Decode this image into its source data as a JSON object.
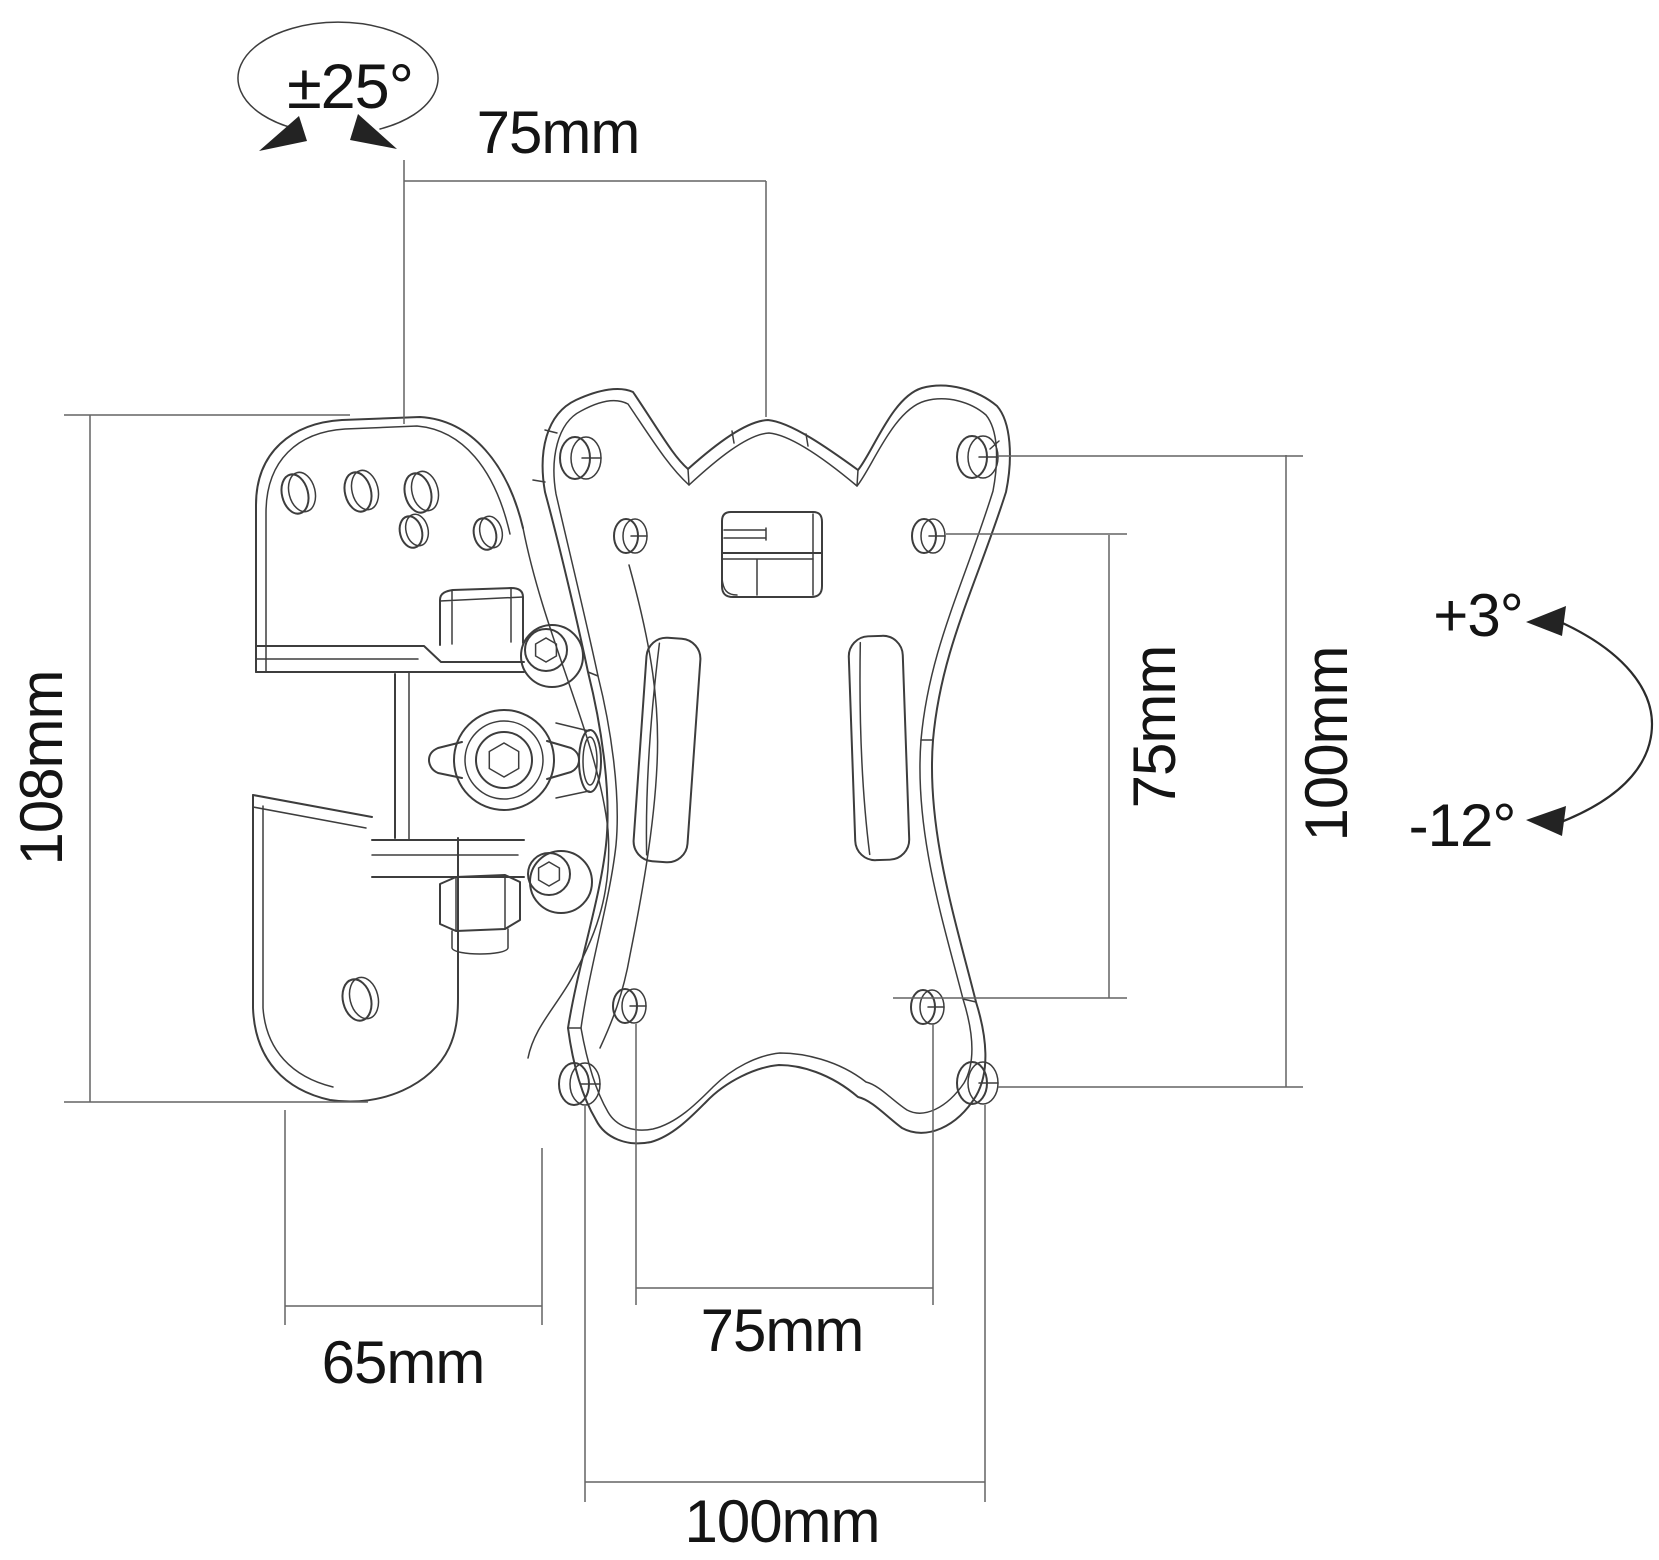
{
  "page": {
    "title": "Wall mount bracket dimension drawing",
    "type": "technical-drawing"
  },
  "colors": {
    "background": "#ffffff",
    "outline": "#3d3d3d",
    "dimension_line": "#646464",
    "label_text": "#141414",
    "arrow_fill": "#232323"
  },
  "labels": {
    "swivel_range": "±25°",
    "top_width": "75mm",
    "left_height": "108mm",
    "wall_depth": "65mm",
    "bottom_inner_width": "75mm",
    "bottom_outer_width": "100mm",
    "right_inner_height": "75mm",
    "right_outer_height": "100mm",
    "tilt_up": "+3°",
    "tilt_down": "-12°"
  }
}
